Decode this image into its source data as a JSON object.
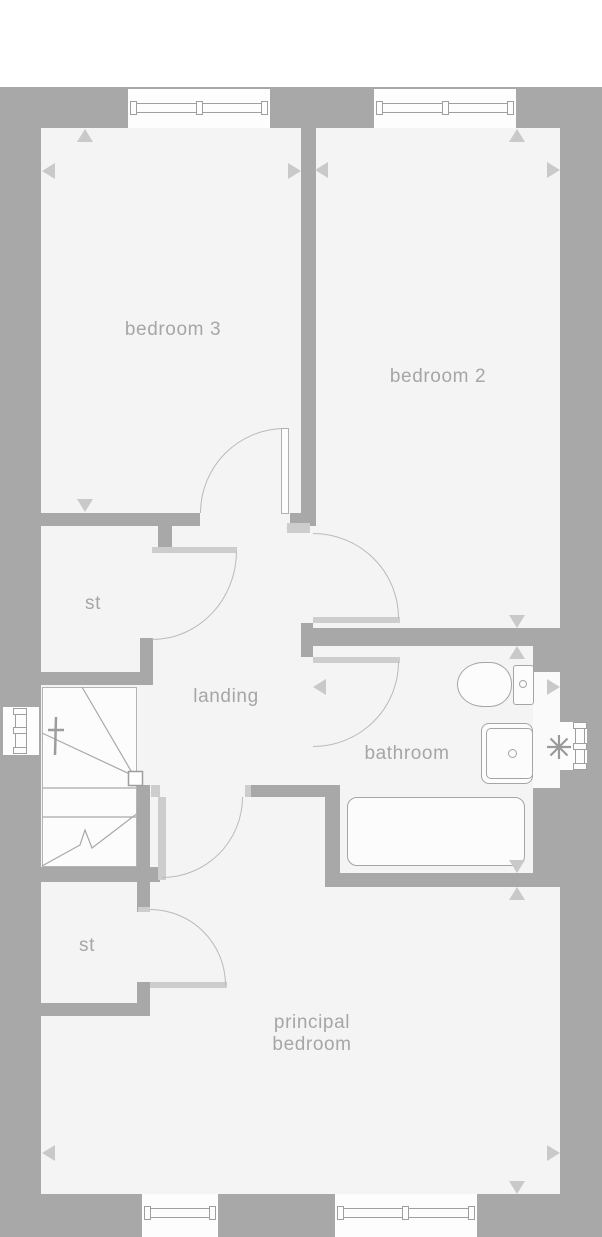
{
  "plan": {
    "type": "floor-plan",
    "rooms": {
      "bedroom3": {
        "label": "bedroom 3"
      },
      "bedroom2": {
        "label": "bedroom 2"
      },
      "storage_upper": {
        "label": "st"
      },
      "landing": {
        "label": "landing"
      },
      "bathroom": {
        "label": "bathroom"
      },
      "storage_lower": {
        "label": "st"
      },
      "principal_bedroom": {
        "label_line1": "principal",
        "label_line2": "bedroom"
      }
    },
    "symbols": {
      "fixtures": [
        "toilet",
        "sink",
        "bathtub",
        "staircase"
      ],
      "window_count": 6,
      "door_swing_count": 6,
      "dimension_arrow_sets": [
        "bedroom3",
        "bedroom2",
        "bathroom",
        "principal_bedroom"
      ],
      "obscured_glazing_marker": "asterisk",
      "stair_direction_marker": "dagger"
    },
    "colors": {
      "wall": "#a9a8a8",
      "floor": "#f4f4f4",
      "window": "#fdfdfd",
      "door_lining": "#cdcdcd",
      "door_arc": "#bababa",
      "label_text": "#a6a6a6",
      "dimension_arrow": "#c9c9c9",
      "fixture_outline": "#a5a5a5"
    }
  }
}
